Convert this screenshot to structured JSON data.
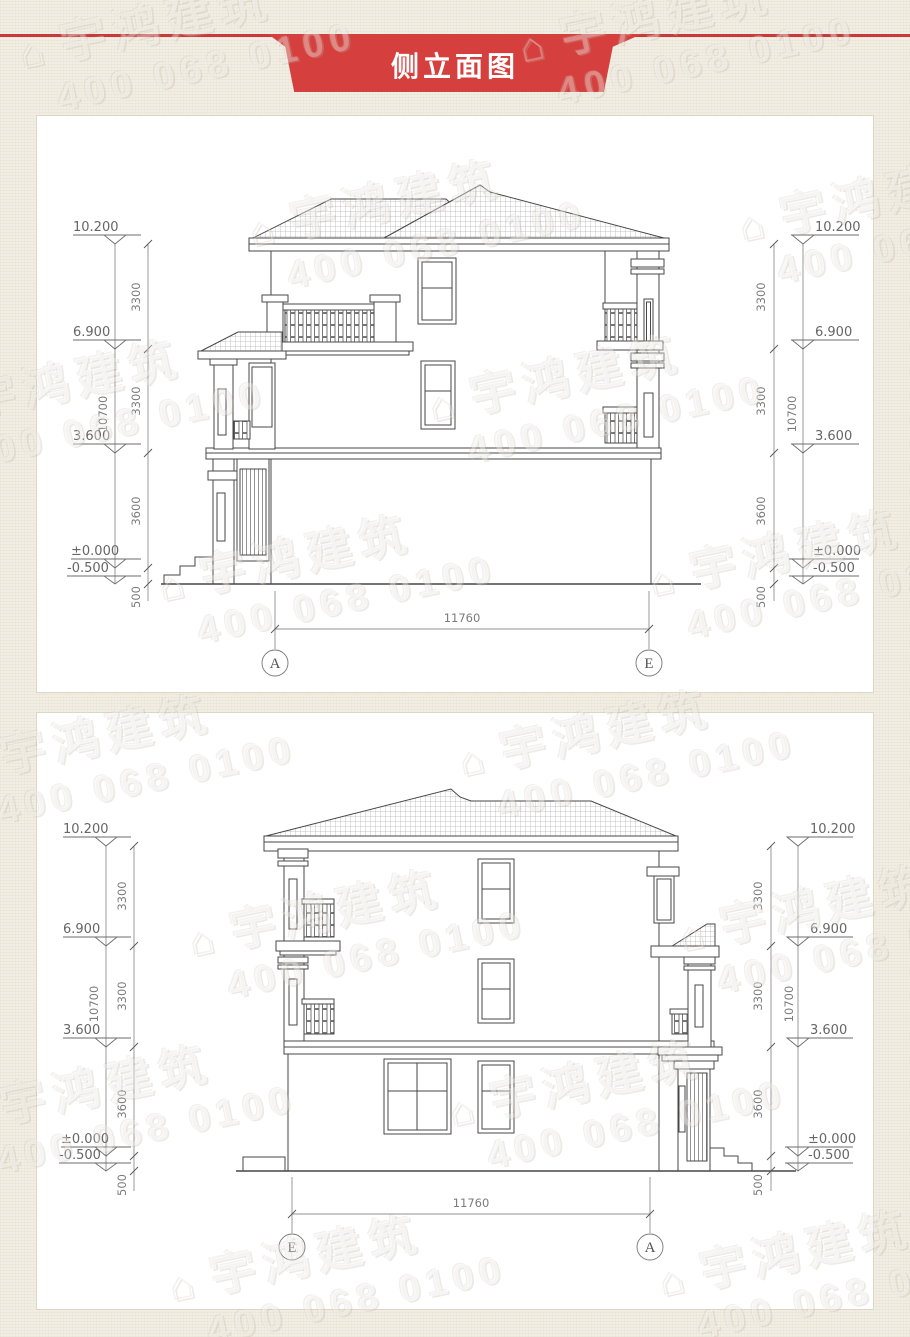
{
  "banner": {
    "title": "侧立面图"
  },
  "watermark": {
    "logo_glyph": "⌂",
    "brand": "宇鸿建筑",
    "phone": "400 068 0100"
  },
  "drawing1": {
    "grid_left": "A",
    "grid_right": "E",
    "span_dim": "11760",
    "levels": {
      "roof": "10.200",
      "floor3": "6.900",
      "floor2": "3.600",
      "ground": "±0.000",
      "site": "-0.500"
    },
    "dims": {
      "seg_top": "3300",
      "seg_mid": "3300",
      "seg_low": "3600",
      "seg_site": "500",
      "total": "10700"
    }
  },
  "drawing2": {
    "grid_left": "E",
    "grid_right": "A",
    "span_dim": "11760",
    "levels": {
      "roof": "10.200",
      "floor3": "6.900",
      "floor2": "3.600",
      "ground": "±0.000",
      "site": "-0.500"
    },
    "dims": {
      "seg_top": "3300",
      "seg_mid": "3300",
      "seg_low": "3600",
      "seg_site": "500",
      "total": "10700"
    }
  }
}
